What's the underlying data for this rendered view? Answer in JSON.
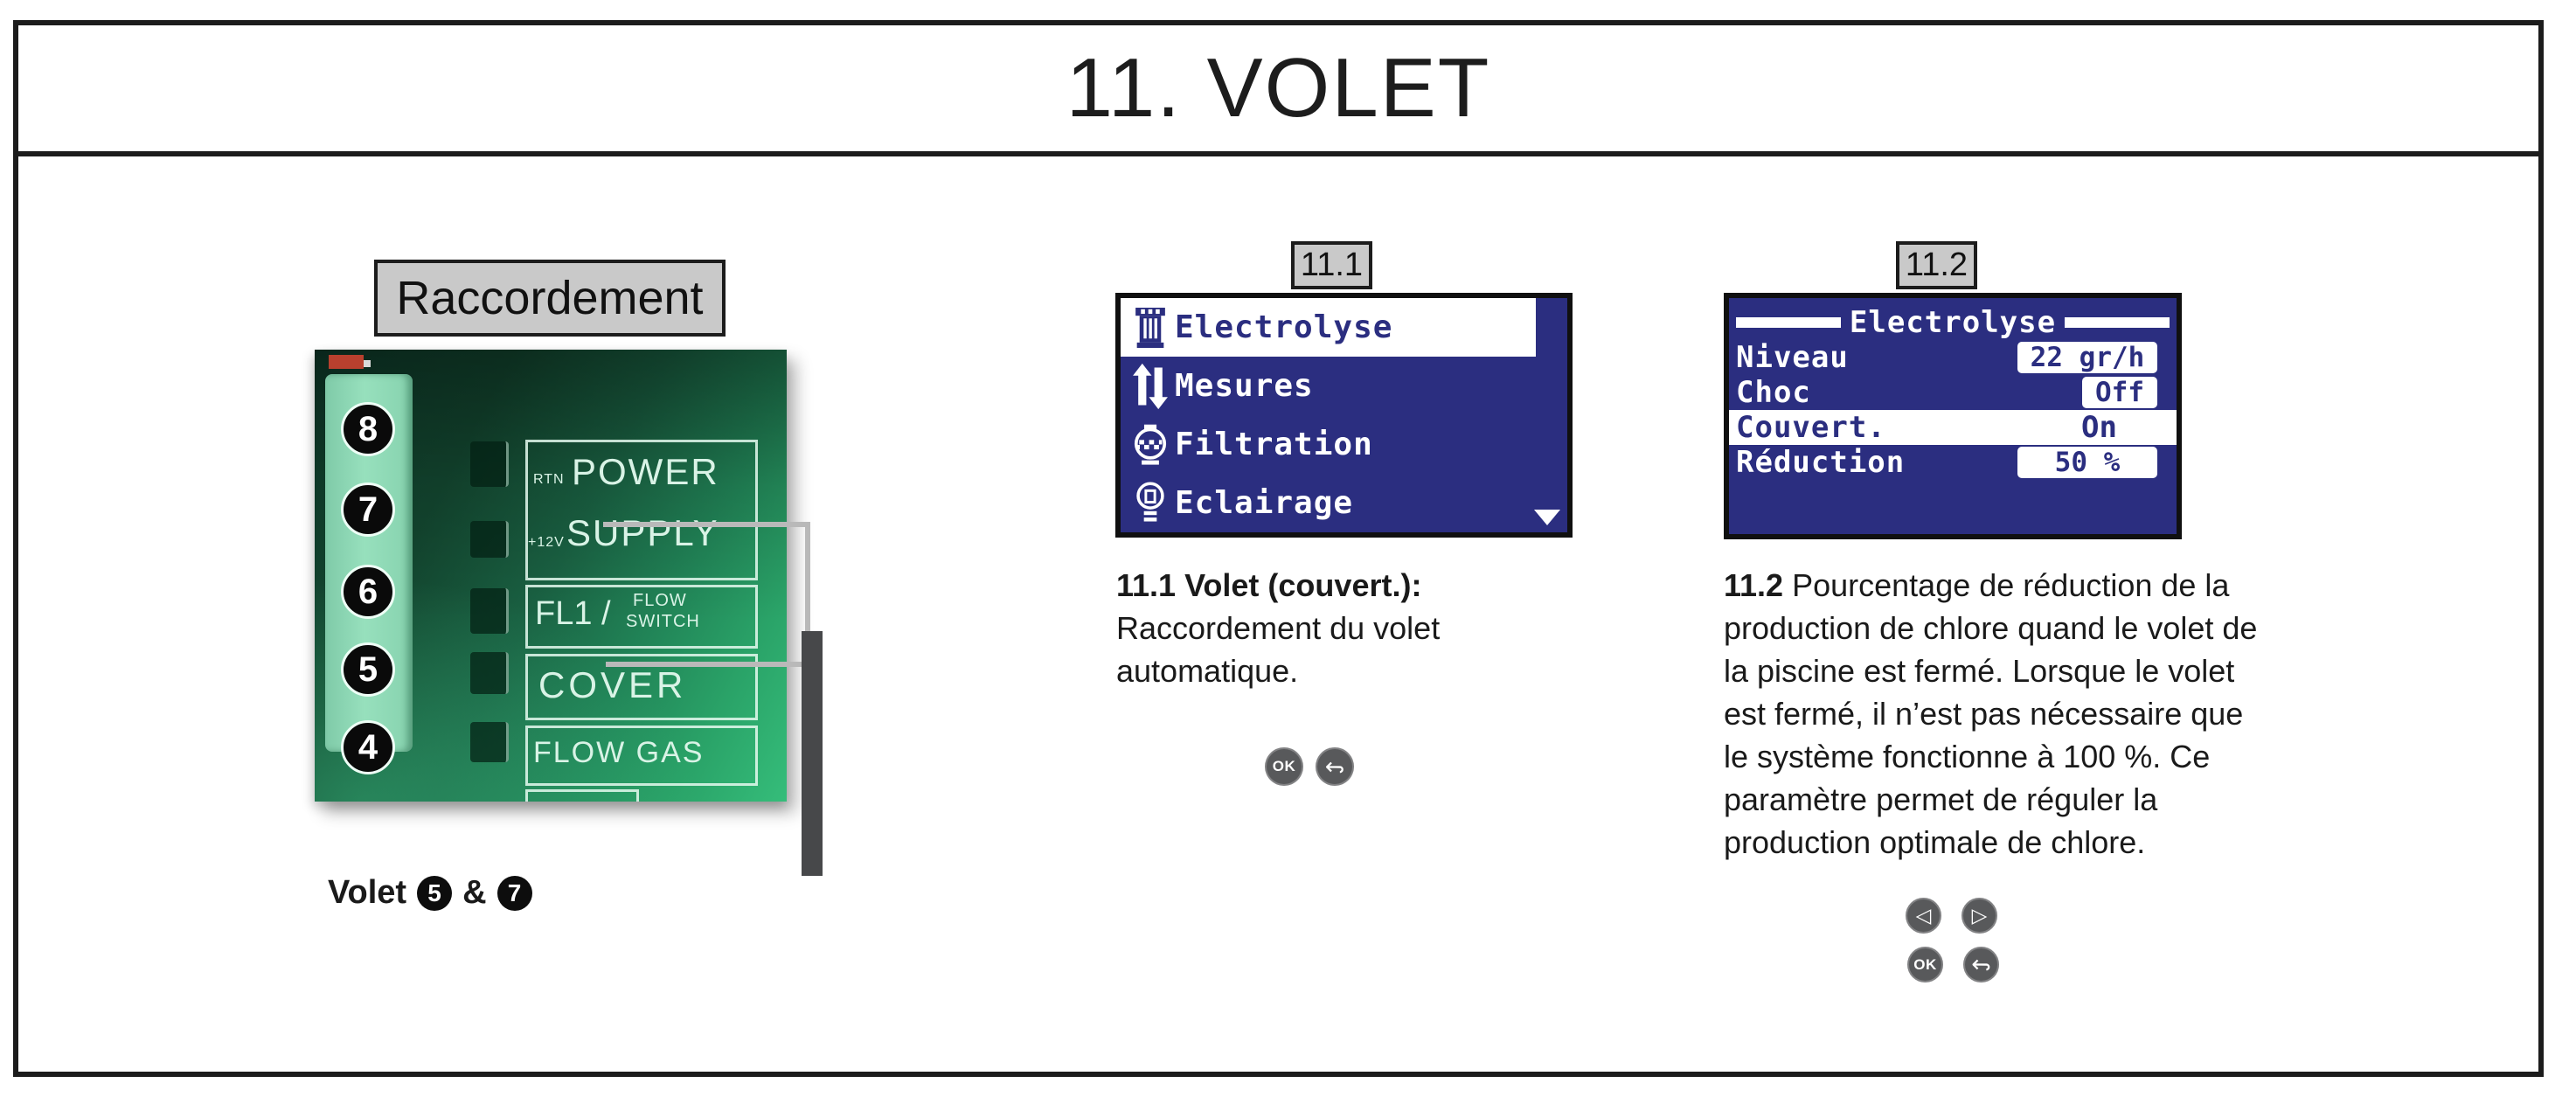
{
  "page": {
    "title": "11. VOLET"
  },
  "connection": {
    "box_label": "Raccordement",
    "photo": {
      "terminals": [
        "8",
        "7",
        "6",
        "5",
        "4"
      ],
      "labels": {
        "rtn": "RTN",
        "power": "POWER",
        "plus12v": "+12V",
        "supply": "SUPPLY",
        "fl1": "FL1 /",
        "flow": "FLOW",
        "switch": "SWITCH",
        "cover": "COVER",
        "flow_gas": "FLOW GAS"
      }
    },
    "caption": {
      "prefix": "Volet",
      "terminal_a": "5",
      "joiner": "&",
      "terminal_b": "7"
    }
  },
  "figures": [
    {
      "tag": "11.1",
      "screen": {
        "menu": [
          {
            "icon": "electrolysis-icon",
            "label": "Electrolyse",
            "selected": true
          },
          {
            "icon": "measures-arrows-icon",
            "label": "Mesures",
            "selected": false
          },
          {
            "icon": "filtration-icon",
            "label": "Filtration",
            "selected": false
          },
          {
            "icon": "lighting-bulb-icon",
            "label": "Eclairage",
            "selected": false
          }
        ],
        "scroll_down_icon": "triangle-down"
      },
      "heading": "11.1 Volet (couvert.):",
      "body": "Raccordement du volet automatique.",
      "buttons": {
        "ok_label": "OK",
        "back_glyph": "↩"
      }
    },
    {
      "tag": "11.2",
      "screen": {
        "title": "Electrolyse",
        "rows": [
          {
            "label": "Niveau",
            "value": "22 gr/h",
            "selected": false
          },
          {
            "label": "Choc",
            "value": "Off",
            "selected": false
          },
          {
            "label": "Couvert.",
            "value": "On",
            "selected": true
          },
          {
            "label": "Réduction",
            "value": "50 %",
            "selected": false
          }
        ]
      },
      "body_lead": "11.2",
      "body": "Pourcentage de réduction de la production de chlore quand le volet de la piscine est fermé. Lorsque le volet est fermé, il n’est pas nécessaire que le système fonctionne à 100 %. Ce paramètre permet de réguler la production optimale de chlore.",
      "buttons": {
        "prev_glyph": "◁",
        "next_glyph": "▷",
        "ok_label": "OK",
        "back_glyph": "↩"
      }
    }
  ],
  "colors": {
    "lcd_navy": "#2b2e80",
    "tag_box_gray": "#c9c9c9",
    "button_gray": "#58595b",
    "connector_line_gray": "#b9b9b9",
    "cable_bar_dark": "#47484a",
    "pcb_green": "#1a6243",
    "frame_black": "#1c1c1c"
  }
}
